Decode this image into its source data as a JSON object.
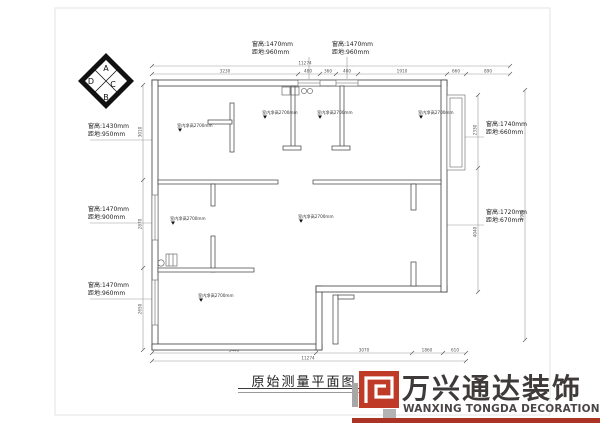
{
  "page": {
    "title": "原始测量平面图"
  },
  "compass": {
    "a": "A",
    "b": "B",
    "c": "C",
    "d": "D"
  },
  "annotations": {
    "top1": {
      "line1": "窗高:1470mm",
      "line2": "距地:960mm"
    },
    "top2": {
      "line1": "窗高:1470mm",
      "line2": "距地:960mm"
    },
    "left1": {
      "line1": "窗高:1430mm",
      "line2": "距地:950mm"
    },
    "left2": {
      "line1": "窗高:1470mm",
      "line2": "距地:900mm"
    },
    "left3": {
      "line1": "窗高:1470mm",
      "line2": "距地:960mm"
    },
    "right1": {
      "line1": "窗高:1740mm",
      "line2": "距地:660mm"
    },
    "right2": {
      "line1": "窗高:1720mm",
      "line2": "距地:670mm"
    }
  },
  "rooms": {
    "labels": [
      "室内净高2700mm",
      "室内净高2700mm",
      "室内净高2700mm",
      "室内净高2700mm",
      "室内净高2700mm",
      "室内净高2700mm",
      "室内净高2700mm"
    ]
  },
  "dims": {
    "top_overall": "11274",
    "top": [
      "3230",
      "480",
      "360",
      "480",
      "1910",
      "660",
      "890"
    ],
    "bottom": [
      "3440",
      "3070",
      "1860",
      "610"
    ],
    "bottom_overall": "11274",
    "left": [
      "3010",
      "2870",
      "2650"
    ],
    "right": [
      "2330",
      "4040"
    ],
    "right_far": "8980"
  },
  "logo": {
    "cn": "万兴通达装饰",
    "en": "WANXING TONGDA DECORATION",
    "red": "#bf3a27",
    "strip_red": "#ac3425",
    "gray": "#a7a7a7"
  }
}
